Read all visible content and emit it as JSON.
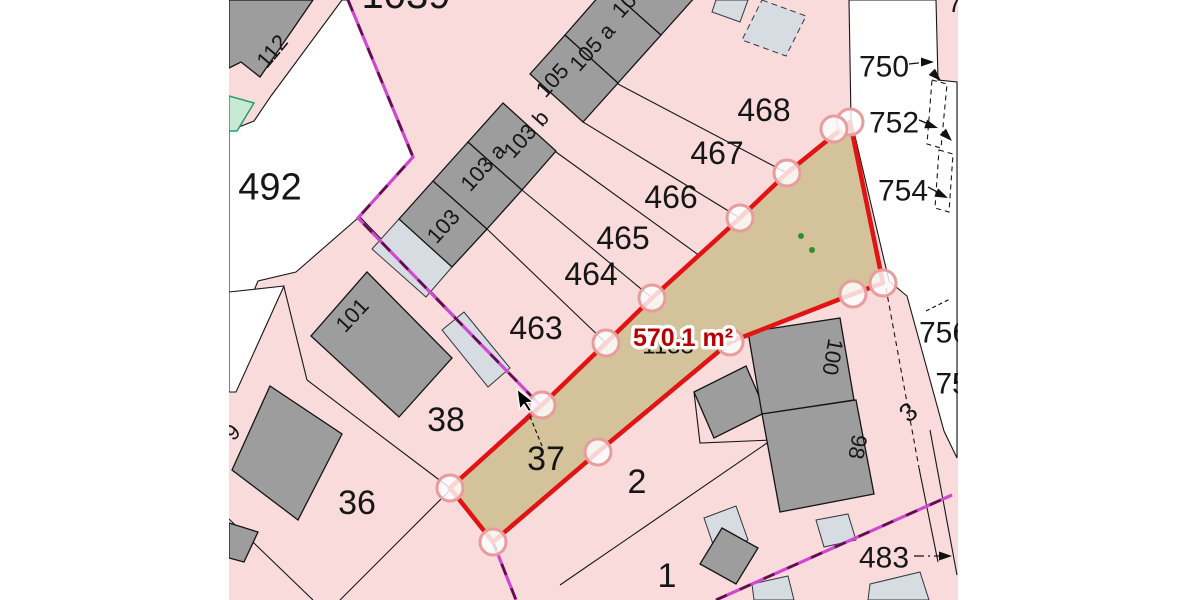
{
  "title": "Cadastral parcel map",
  "colors": {
    "parcel_pink": "#f9dbdc",
    "building_gray": "#9d9d9d",
    "annex_light_gray": "#d7dce2",
    "selected_parcel_tan": "#d4c29a",
    "selection_red": "#e11313",
    "vertex_ring": "#e89c9c",
    "boundary_magenta": "#cf49cf",
    "boundary_dash": "#5c1145",
    "green_area": "#c8ead5",
    "area_label_red": "#b80000"
  },
  "selection": {
    "area_text": "570.1 m²",
    "polygon": [
      [
        850,
        122
      ],
      [
        883,
        283
      ],
      [
        853,
        294
      ],
      [
        730,
        342
      ],
      [
        598,
        452
      ],
      [
        493,
        542
      ],
      [
        450,
        488
      ],
      [
        542,
        405
      ],
      [
        606,
        343
      ],
      [
        652,
        298
      ],
      [
        740,
        218
      ],
      [
        787,
        173
      ]
    ],
    "vertices": [
      [
        850,
        122
      ],
      [
        834,
        129
      ],
      [
        883,
        283
      ],
      [
        853,
        294
      ],
      [
        730,
        342
      ],
      [
        787,
        173
      ],
      [
        740,
        218
      ],
      [
        652,
        298
      ],
      [
        606,
        343
      ],
      [
        542,
        405
      ],
      [
        450,
        488
      ],
      [
        493,
        542
      ],
      [
        598,
        452
      ]
    ]
  },
  "dots": [
    [
      801,
      236
    ],
    [
      812,
      250
    ]
  ],
  "labels": [
    {
      "name": "parcel-label-1039",
      "text": "1039",
      "x": 406,
      "y": -6,
      "size": 40
    },
    {
      "name": "parcel-label-7-clipped",
      "text": "7",
      "x": 955,
      "y": 3,
      "size": 26
    },
    {
      "name": "house-label-112",
      "text": "112",
      "x": 272,
      "y": 51,
      "size": 22,
      "rot": -50
    },
    {
      "name": "parcel-label-492",
      "text": "492",
      "x": 270,
      "y": 186,
      "size": 38
    },
    {
      "name": "house-label-103",
      "text": "103",
      "x": 443,
      "y": 226,
      "size": 22,
      "rot": -48
    },
    {
      "name": "house-label-103a",
      "text": "103 a",
      "x": 483,
      "y": 167,
      "size": 22,
      "rot": -48
    },
    {
      "name": "house-label-103b",
      "text": "103 b",
      "x": 526,
      "y": 134,
      "size": 22,
      "rot": -48
    },
    {
      "name": "house-label-105",
      "text": "105",
      "x": 552,
      "y": 80,
      "size": 22,
      "rot": -48
    },
    {
      "name": "house-label-105a",
      "text": "105 a",
      "x": 592,
      "y": 47,
      "size": 22,
      "rot": -48
    },
    {
      "name": "house-label-10-clipped",
      "text": "10",
      "x": 624,
      "y": 5,
      "size": 22,
      "rot": -48
    },
    {
      "name": "parcel-label-468",
      "text": "468",
      "x": 764,
      "y": 110,
      "size": 32
    },
    {
      "name": "parcel-label-467",
      "text": "467",
      "x": 717,
      "y": 153,
      "size": 32
    },
    {
      "name": "parcel-label-466",
      "text": "466",
      "x": 671,
      "y": 197,
      "size": 32
    },
    {
      "name": "parcel-label-465",
      "text": "465",
      "x": 623,
      "y": 238,
      "size": 32
    },
    {
      "name": "parcel-label-464",
      "text": "464",
      "x": 591,
      "y": 274,
      "size": 32
    },
    {
      "name": "parcel-label-463",
      "text": "463",
      "x": 536,
      "y": 328,
      "size": 32
    },
    {
      "name": "house-label-101",
      "text": "101",
      "x": 352,
      "y": 315,
      "size": 22,
      "rot": -47
    },
    {
      "name": "house-label-9-clipped",
      "text": "9",
      "x": 232,
      "y": 432,
      "size": 22,
      "rot": -45
    },
    {
      "name": "parcel-label-38",
      "text": "38",
      "x": 446,
      "y": 419,
      "size": 34
    },
    {
      "name": "parcel-label-37",
      "text": "37",
      "x": 546,
      "y": 458,
      "size": 34
    },
    {
      "name": "parcel-label-36",
      "text": "36",
      "x": 357,
      "y": 502,
      "size": 34
    },
    {
      "name": "parcel-label-2",
      "text": "2",
      "x": 637,
      "y": 481,
      "size": 34
    },
    {
      "name": "parcel-label-1",
      "text": "1",
      "x": 667,
      "y": 575,
      "size": 34
    },
    {
      "name": "parcel-label-750",
      "text": "750",
      "x": 884,
      "y": 66,
      "size": 30
    },
    {
      "name": "parcel-label-752",
      "text": "752",
      "x": 894,
      "y": 122,
      "size": 30
    },
    {
      "name": "parcel-label-754",
      "text": "754",
      "x": 903,
      "y": 190,
      "size": 30
    },
    {
      "name": "parcel-label-756-clipped",
      "text": "756",
      "x": 944,
      "y": 332,
      "size": 30
    },
    {
      "name": "parcel-label-75-clipped",
      "text": "75",
      "x": 952,
      "y": 383,
      "size": 30
    },
    {
      "name": "parcel-label-3",
      "text": "3",
      "x": 908,
      "y": 412,
      "size": 26,
      "rot": -40
    },
    {
      "name": "house-label-100",
      "text": "100",
      "x": 833,
      "y": 357,
      "size": 22,
      "rot": 100
    },
    {
      "name": "house-label-98",
      "text": "98",
      "x": 858,
      "y": 447,
      "size": 22,
      "rot": 100
    },
    {
      "name": "parcel-label-483",
      "text": "483",
      "x": 884,
      "y": 557,
      "size": 30
    },
    {
      "name": "hidden-parcel-number",
      "text": "1133",
      "x": 668,
      "y": 345,
      "size": 24,
      "cls": "hidden"
    },
    {
      "name": "selected-area-label",
      "text": "570.1 m²",
      "x": 683,
      "y": 337,
      "size": 25,
      "cls": "area"
    }
  ]
}
